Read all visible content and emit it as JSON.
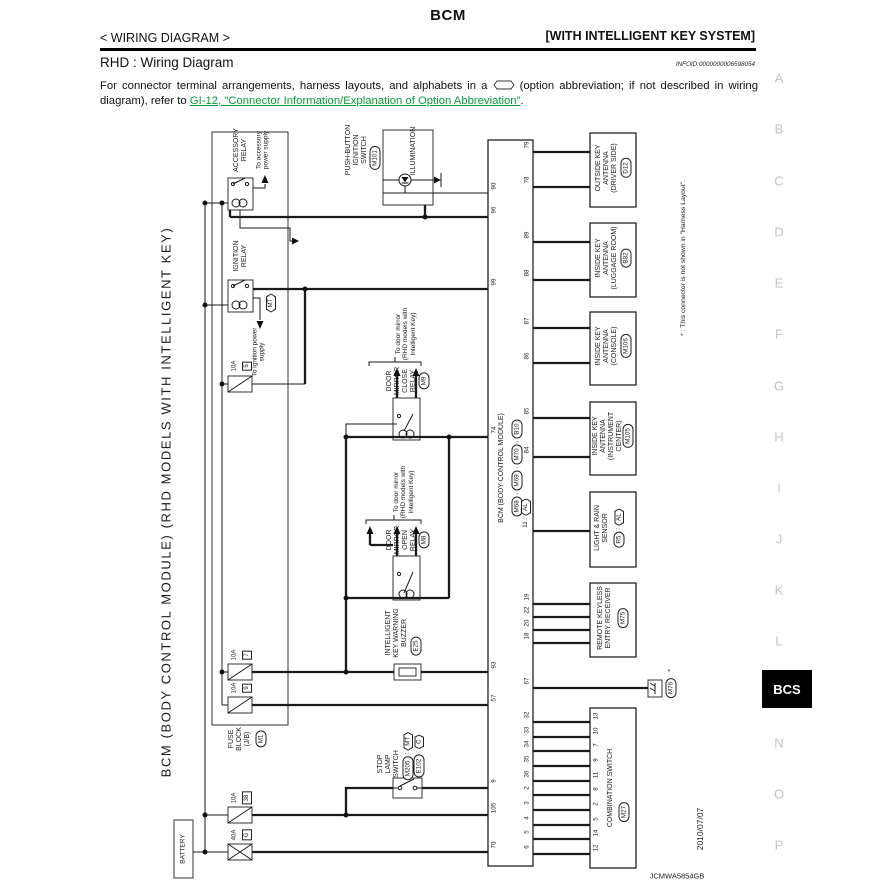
{
  "header": {
    "title": "BCM",
    "left": "< WIRING DIAGRAM >",
    "right": "[WITH INTELLIGENT KEY SYSTEM]",
    "section": "RHD : Wiring Diagram",
    "infoid": "INFOID:0000000006598054",
    "note_1": "For connector terminal arrangements, harness layouts, and alphabets in a",
    "note_2": "(option abbreviation; if not described in wiring diagram), refer to",
    "link": "GI-12, \"Connector Information/Explanation of Option Abbreviation\"",
    "period": "."
  },
  "margin": {
    "letters": [
      "A",
      "B",
      "C",
      "D",
      "E",
      "F",
      "G",
      "H",
      "I",
      "J",
      "K",
      "L"
    ],
    "tab": "BCS",
    "letters2": [
      "N",
      "O",
      "P"
    ]
  },
  "footer": {
    "date": "2010/07/07",
    "code": "JCMWA5854GB"
  },
  "d": {
    "colon": ":",
    "side": "BCM (BODY CONTROL MODULE) (RHD MODELS WITH INTELLIGENT KEY)",
    "battery": "BATTERY",
    "fuse_block": {
      "label": "FUSE\nBLOCK\n(J/B)",
      "conn": "M1"
    },
    "fuses": {
      "f5a": "10A",
      "f5n": "5",
      "f7a": "10A",
      "f7n": "7",
      "f9a": "10A",
      "f9n": "9",
      "f38a": "10A",
      "f38n": "38",
      "f40a": "40A",
      "f40n": "G"
    },
    "acc": {
      "name": "ACCESSORY\nRELAY",
      "out": "To accessory\npower supply"
    },
    "ign": {
      "name": "IGNITION\nRELAY",
      "out": "To ignition power\nsupply",
      "opt": "MT"
    },
    "pbis": {
      "name": "PUSH-BUTTON\nIGNITION\nSWITCH",
      "conn": "M101",
      "illum": "ILLUMINATION"
    },
    "close_relay": {
      "name": "DOOR\nMIRROR\nCLOSE\nRELAY",
      "conn": "M9",
      "note": "To door mirror\n(RHD models with\nIntelligent Key)"
    },
    "open_relay": {
      "name": "DOOR\nMIRROR\nOPEN\nRELAY",
      "conn": "M8",
      "note": "To door mirror\n(RHD models with\nIntelligent Key)"
    },
    "buzzer": {
      "name": "INTELLIGENT\nKEY WARNING\nBUZZER",
      "conn": "E25"
    },
    "stop": {
      "name": "STOP\nLAMP\nSWITCH",
      "c1": "M205",
      "o1": "MT",
      "c2": "E102",
      "o2": "C"
    },
    "bcm": {
      "label": "BCM (BODY CONTROL MODULE)",
      "c1": "M68",
      "c2": "M69",
      "c3": "M70",
      "c4": "B10",
      "sep": ",",
      "left_pins": [
        "90",
        "96",
        "99",
        "74",
        "93",
        "57",
        "9",
        "105",
        "70"
      ],
      "right_top": [
        "79",
        "78",
        "89",
        "88",
        "87",
        "86",
        "85",
        "84"
      ],
      "pin11": "11 :",
      "pin11_opt": "AL",
      "right_mid": [
        "19",
        "22",
        "20",
        "18",
        "67"
      ],
      "comb": [
        "32",
        "33",
        "34",
        "35",
        "36",
        "2",
        "3",
        "4",
        "5",
        "6"
      ]
    },
    "ant_drv": {
      "name": "OUTSIDE KEY\nANTENNA\n(DRIVER SIDE)",
      "conn": "D12"
    },
    "ant_lug": {
      "name": "INSIDE KEY\nANTENNA\n(LUGGAGE ROOM)",
      "conn": "B82"
    },
    "ant_con": {
      "name": "INSIDE KEY\nANTENNA\n(CONSOLE)",
      "conn": "M106"
    },
    "ant_ins": {
      "name": "INSIDE KEY\nANTENNA\n(INSTRUMENT\nCENTER)",
      "conn": "M105"
    },
    "rain": {
      "name": "LIGHT & RAIN\nSENSOR",
      "conn": "R5",
      "opt": "AL"
    },
    "keyless": {
      "name": "REMOTE KEYLESS\nENTRY RECEIVER",
      "conn": "M75"
    },
    "m76": {
      "conn": "M76",
      "star": "*"
    },
    "comb_sw": {
      "name": "COMBINATION SWITCH",
      "conn": "M27",
      "pins": [
        "13",
        "10",
        "7",
        "9",
        "11",
        "8",
        "2",
        "5",
        "14",
        "12"
      ]
    },
    "footnote": "* : This connector is not shown in \"Harness Layout\"."
  }
}
